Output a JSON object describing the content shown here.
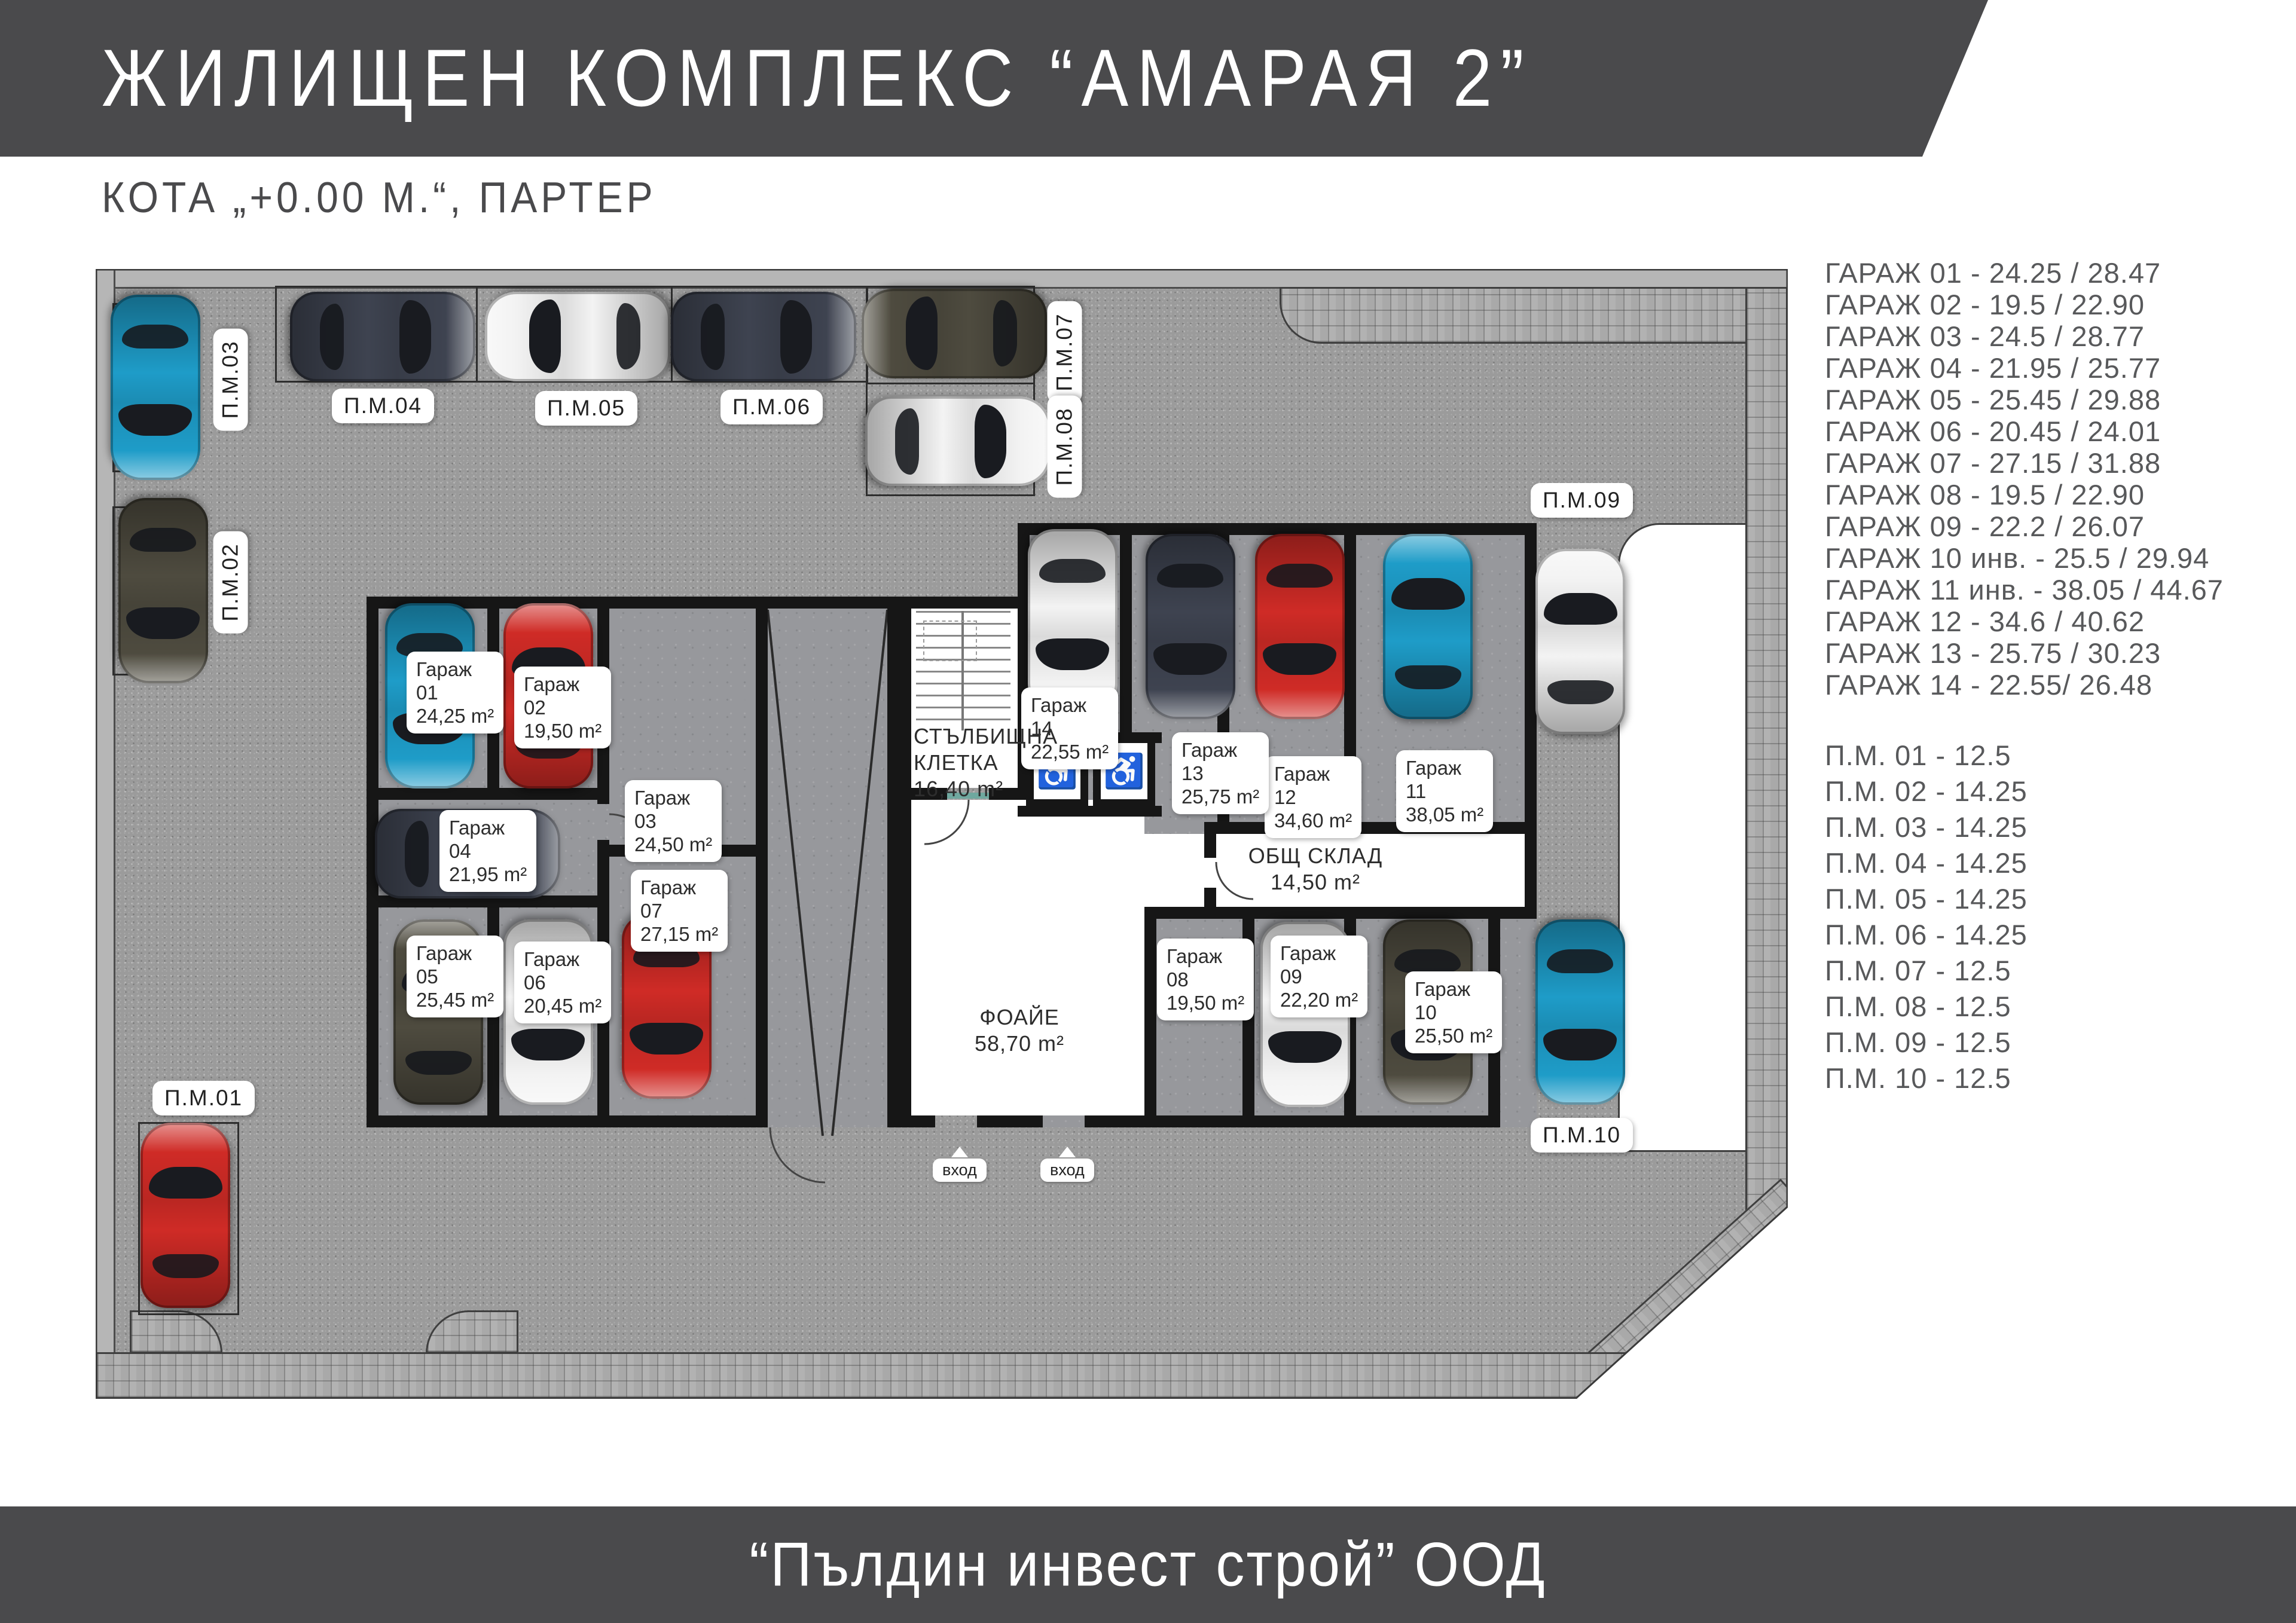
{
  "header": {
    "title": "ЖИЛИЩЕН КОМПЛЕКС “АМАРАЯ 2”",
    "subtitle": "КОТА „+0.00 М.“, ПАРТЕР"
  },
  "footer": {
    "company": "“Пълдин инвест строй” ООД"
  },
  "legend": {
    "garage_lines": [
      "ГАРАЖ 01 - 24.25 / 28.47",
      "ГАРАЖ 02 - 19.5 / 22.90",
      "ГАРАЖ 03 - 24.5 / 28.77",
      "ГАРАЖ 04 - 21.95 / 25.77",
      "ГАРАЖ 05 - 25.45 / 29.88",
      "ГАРАЖ 06 - 20.45 / 24.01",
      "ГАРАЖ 07 - 27.15 / 31.88",
      "ГАРАЖ 08 - 19.5 / 22.90",
      "ГАРАЖ 09 - 22.2 / 26.07",
      "ГАРАЖ 10 инв. - 25.5 / 29.94",
      "ГАРАЖ 11 инв. - 38.05 / 44.67",
      "ГАРАЖ 12 - 34.6 / 40.62",
      "ГАРАЖ 13 - 25.75 / 30.23",
      "ГАРАЖ 14 - 22.55/ 26.48"
    ],
    "pm_lines": [
      "П.М. 01 - 12.5",
      "П.М. 02 - 14.25",
      "П.М. 03 - 14.25",
      "П.М. 04 - 14.25",
      "П.М. 05 - 14.25",
      "П.М. 06 - 14.25",
      "П.М. 07 - 12.5",
      "П.М. 08 - 12.5",
      "П.М. 09 - 12.5",
      "П.М. 10 - 12.5"
    ]
  },
  "plan": {
    "garages": [
      {
        "name": "Гараж",
        "id": "01",
        "area": "24,25 m²"
      },
      {
        "name": "Гараж",
        "id": "02",
        "area": "19,50 m²"
      },
      {
        "name": "Гараж",
        "id": "03",
        "area": "24,50 m²"
      },
      {
        "name": "Гараж",
        "id": "04",
        "area": "21,95 m²"
      },
      {
        "name": "Гараж",
        "id": "05",
        "area": "25,45 m²"
      },
      {
        "name": "Гараж",
        "id": "06",
        "area": "20,45 m²"
      },
      {
        "name": "Гараж",
        "id": "07",
        "area": "27,15 m²"
      },
      {
        "name": "Гараж",
        "id": "08",
        "area": "19,50 m²"
      },
      {
        "name": "Гараж",
        "id": "09",
        "area": "22,20 m²"
      },
      {
        "name": "Гараж",
        "id": "10",
        "area": "25,50 m²"
      },
      {
        "name": "Гараж",
        "id": "11",
        "area": "38,05 m²"
      },
      {
        "name": "Гараж",
        "id": "12",
        "area": "34,60 m²"
      },
      {
        "name": "Гараж",
        "id": "13",
        "area": "25,75 m²"
      },
      {
        "name": "Гараж",
        "id": "14",
        "area": "22,55 m²"
      }
    ],
    "pm_labels": [
      "П.М.01",
      "П.М.02",
      "П.М.03",
      "П.М.04",
      "П.М.05",
      "П.М.06",
      "П.М.07",
      "П.М.08",
      "П.М.09",
      "П.М.10"
    ],
    "rooms": {
      "staircase": {
        "line1": "СТЪЛБИЩНА",
        "line2": "КЛЕТКА",
        "area": "16,40 m²"
      },
      "storage": {
        "line1": "ОБЩ СКЛАД",
        "area": "14,50 m²"
      },
      "foyer": {
        "line1": "ФОАЙЕ",
        "area": "58,70 m²"
      },
      "entrance": "вход"
    }
  },
  "palette": {
    "teal": "#1e9cc8",
    "red": "#cf2b26",
    "white": "#f3f3f3",
    "navy": "#3e4350",
    "olive": "#4e4b3f",
    "banner": "#4a4a4c",
    "asphalt": "#9b9b9b",
    "concrete": "#97989c",
    "pavement": "#a9a9a9",
    "wall": "#161616"
  }
}
